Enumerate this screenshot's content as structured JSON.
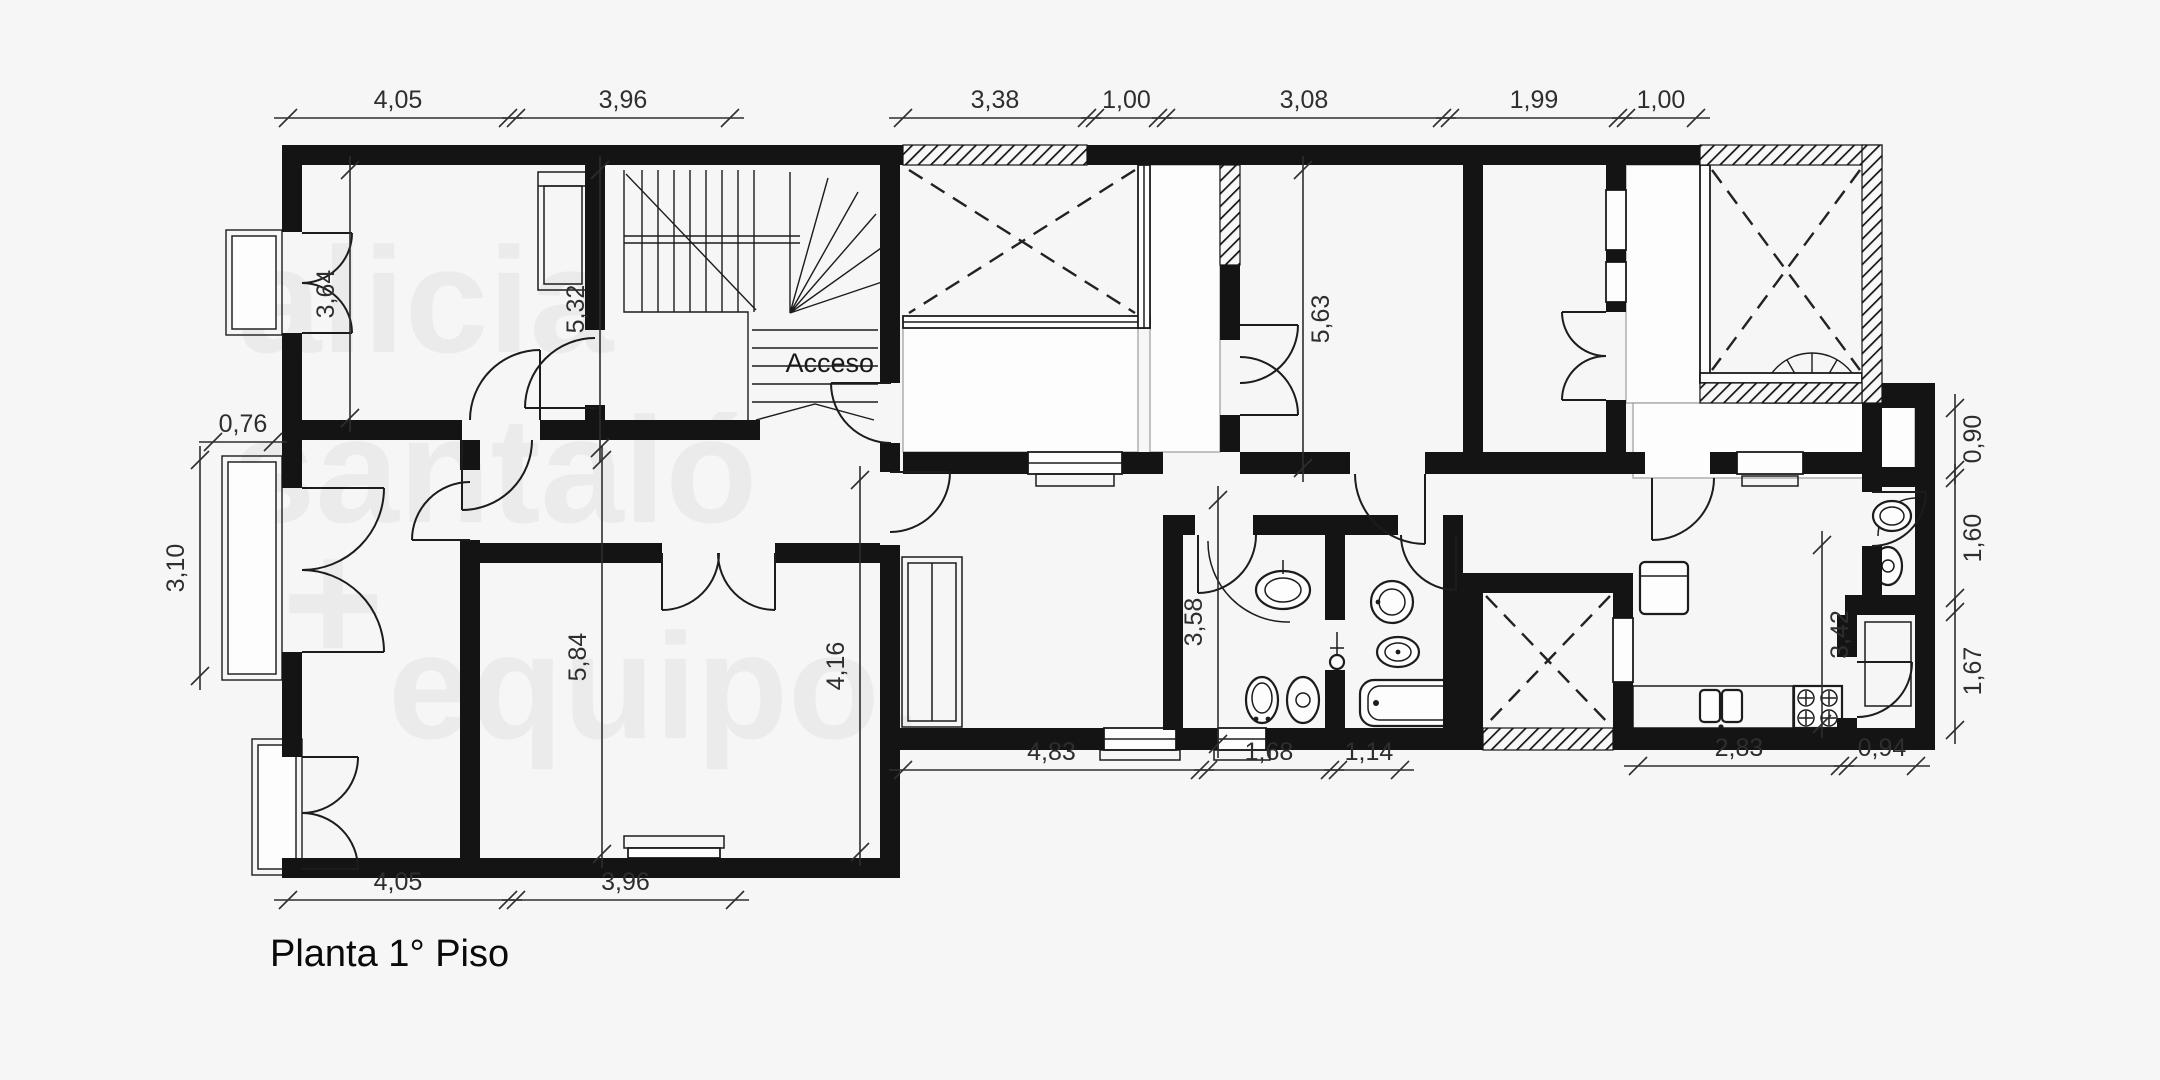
{
  "title": "Planta 1° Piso",
  "labels": {
    "acceso": "Acceso"
  },
  "watermark": {
    "line1": "alicia",
    "line2": "santaló",
    "line3": "+",
    "line4": "equipo."
  },
  "dimensions": {
    "top": [
      "4,05",
      "3,96",
      "3,38",
      "1,00",
      "3,08",
      "1,99",
      "1,00"
    ],
    "bottom_left": [
      "4,05",
      "3,96"
    ],
    "bottom_center": [
      "4,83",
      "1,68",
      "1,14"
    ],
    "bottom_right": [
      "2,83",
      "0,94"
    ],
    "right_side": [
      "0,90",
      "1,60",
      "1,67"
    ],
    "left_side": [
      "0,76",
      "3,10"
    ],
    "interior": [
      "3,64",
      "5,32",
      "5,84",
      "4,16",
      "5,63",
      "3,58",
      "3,42"
    ]
  },
  "colors": {
    "background": "#f6f6f6",
    "wall": "#141414",
    "watermark": "#ebebeb",
    "dimension_text": "#2e2e2e"
  }
}
